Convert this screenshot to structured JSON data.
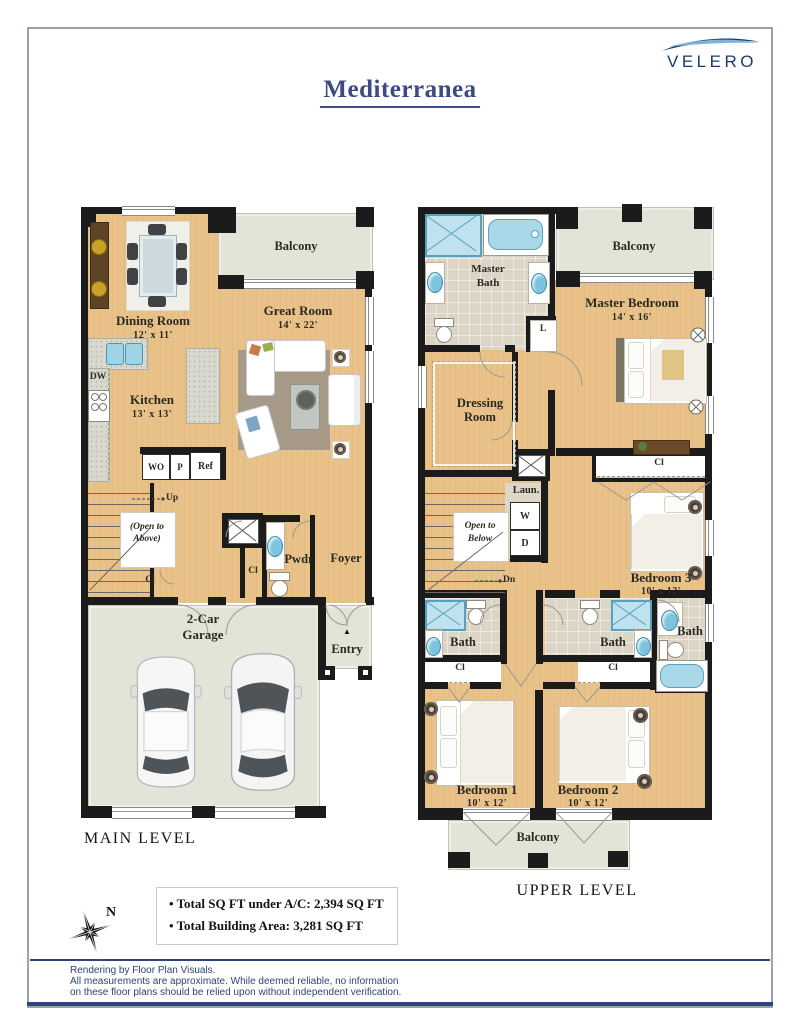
{
  "header": {
    "title": "Mediterranea",
    "brand": "VELERO"
  },
  "floor_plan": {
    "main_level": {
      "title": "MAIN LEVEL",
      "balcony": "Balcony",
      "dining_room": "Dining Room",
      "dining_dims": "12' x 11'",
      "great_room": "Great Room",
      "great_dims": "14' x 22'",
      "kitchen": "Kitchen",
      "kitchen_dims": "13' x 13'",
      "dw": "DW",
      "wo": "WO",
      "pantry": "P",
      "ref": "Ref",
      "up": "Up",
      "open_above_1": "(Open to",
      "open_above_2": "Above)",
      "cl": "Cl",
      "pwdr": "Pwdr",
      "foyer": "Foyer",
      "garage_1": "2-Car",
      "garage_2": "Garage",
      "entry": "Entry",
      "entry_arrow": "▲"
    },
    "upper_level": {
      "title": "UPPER LEVEL",
      "balcony": "Balcony",
      "master_bath_1": "Master",
      "master_bath_2": "Bath",
      "master_bedroom": "Master Bedroom",
      "master_dims": "14' x 16'",
      "linen": "L",
      "dressing_1": "Dressing",
      "dressing_2": "Room",
      "cl": "Cl",
      "laundry": "Laun.",
      "washer": "W",
      "dryer": "D",
      "open_below_1": "Open to",
      "open_below_2": "Below",
      "dn": "Dn",
      "bedroom1": "Bedroom 1",
      "bedroom2": "Bedroom 2",
      "bedroom3": "Bedroom 3",
      "bedroom_dims": "10' x 12'",
      "bath": "Bath"
    }
  },
  "summary": {
    "bullet": "•",
    "line1": "Total SQ FT under A/C: 2,394 SQ FT",
    "line2": "Total Building Area: 3,281 SQ FT"
  },
  "compass": {
    "north": "N"
  },
  "footer": {
    "line1": "Rendering by Floor Plan Visuals.",
    "line2": "All measurements are approximate. While deemed reliable, no information",
    "line3": "on these floor plans should be relied upon without independent verification."
  },
  "colors": {
    "accent_navy": "#2e4379",
    "title_navy": "#3c4b82",
    "floor_tan": "#e9c28a",
    "balcony_gray": "#e3e4d8",
    "fixture_blue": "#a9d9e9",
    "wall_black": "#1b1b1b"
  }
}
